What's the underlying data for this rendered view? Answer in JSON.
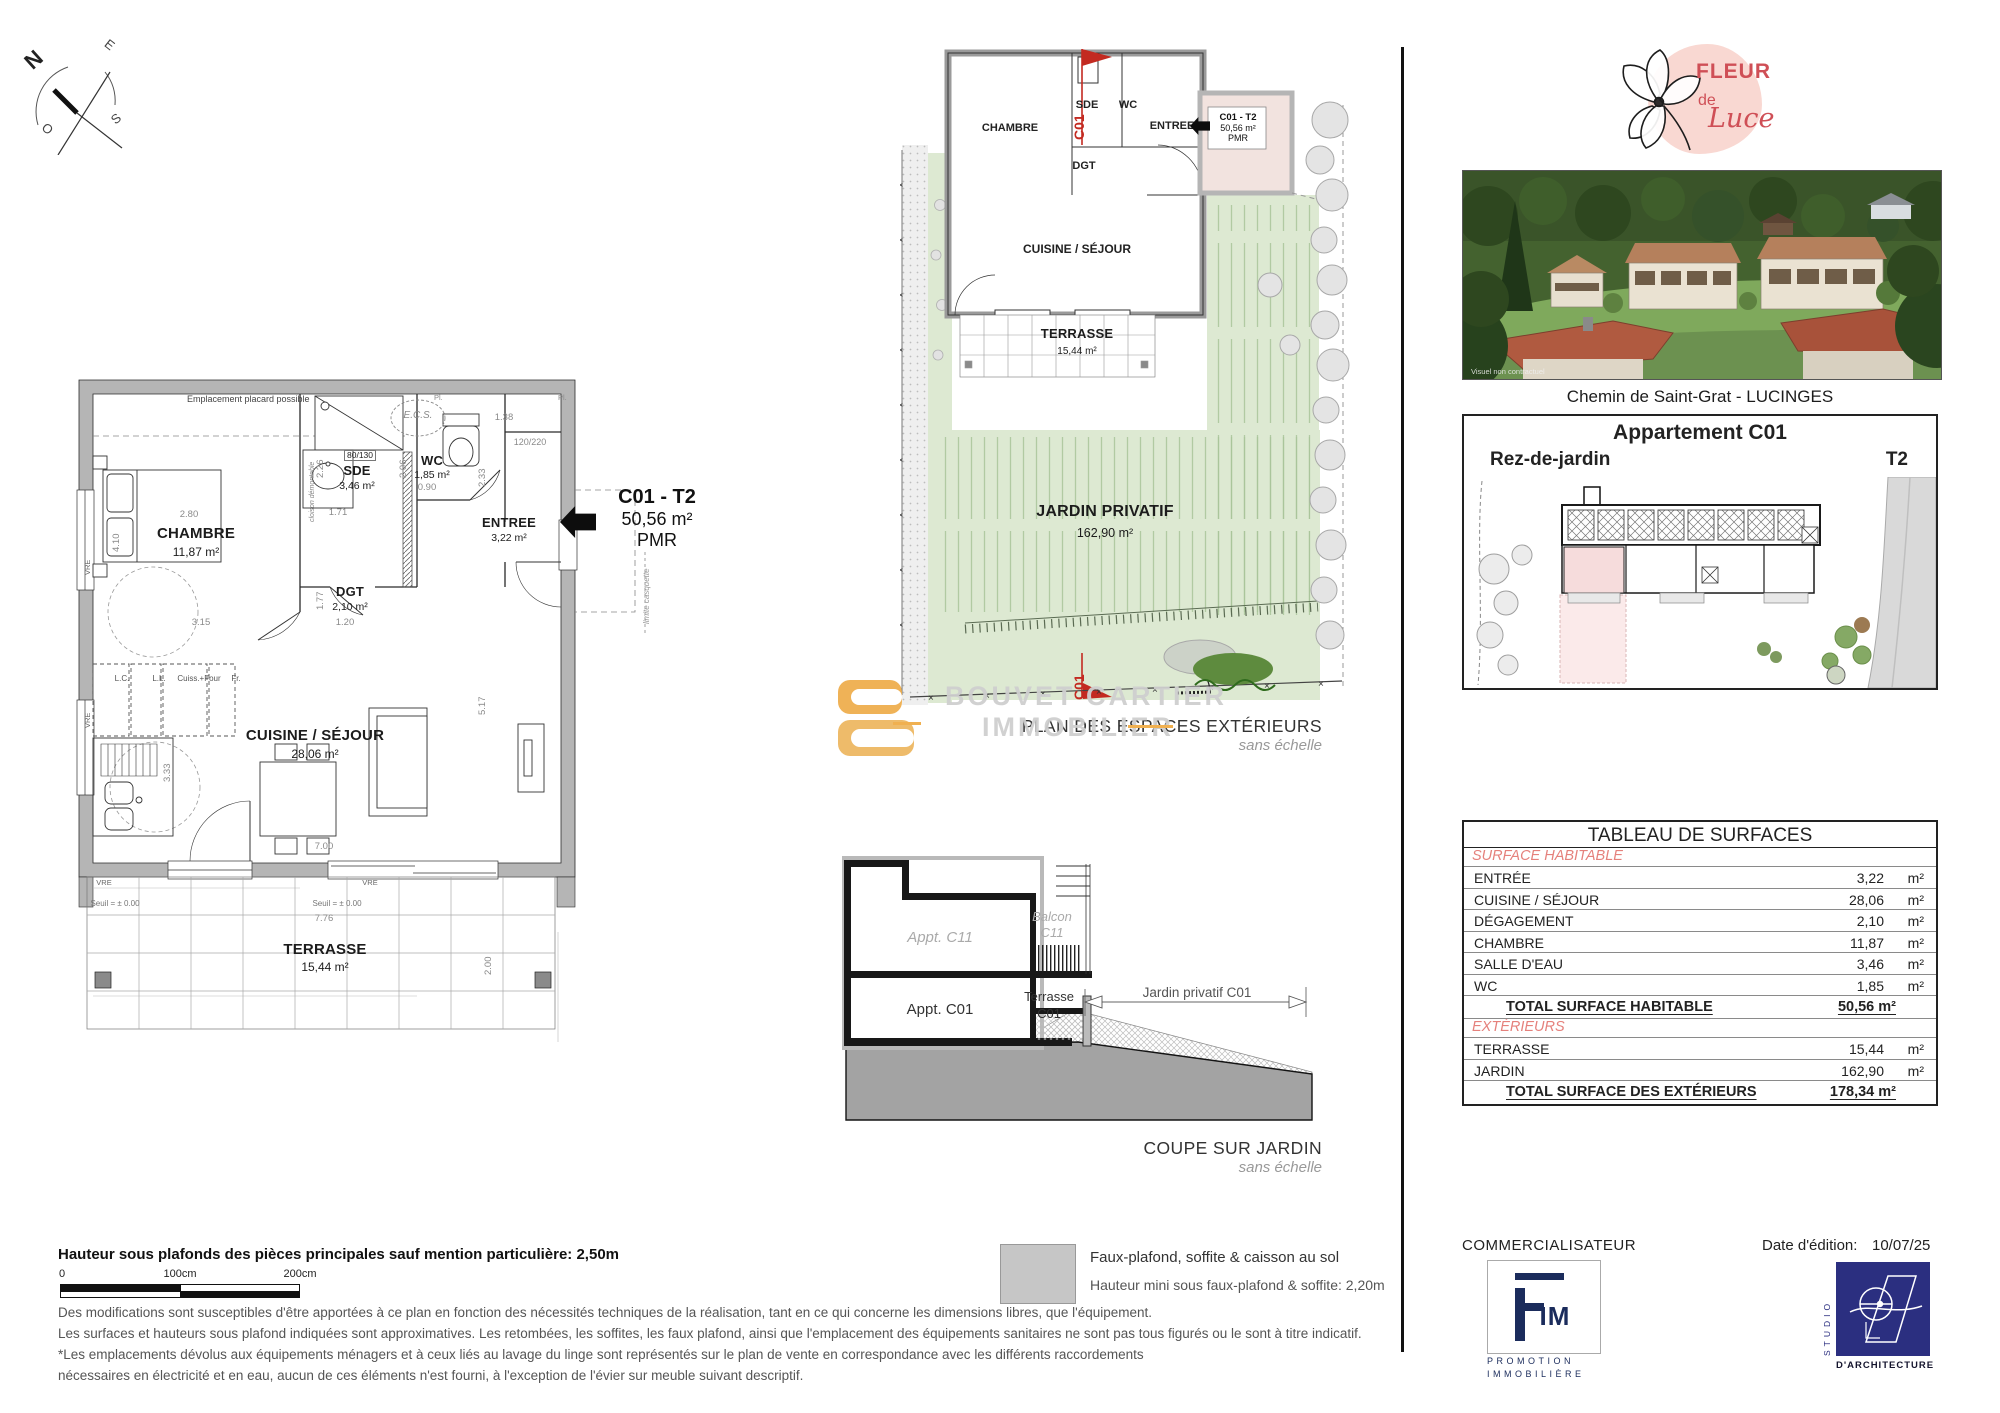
{
  "compass": {
    "n": "N",
    "e": "E",
    "s": "S",
    "o": "O"
  },
  "main_plan": {
    "note_placard": "Emplacement placard possible",
    "rooms": {
      "chambre": {
        "name": "CHAMBRE",
        "area": "11,87 m²"
      },
      "sde": {
        "name": "SDE",
        "area": "3,46 m²"
      },
      "wc": {
        "name": "WC",
        "area": "1,85 m²"
      },
      "entree": {
        "name": "ENTREE",
        "area": "3,22 m²"
      },
      "dgt": {
        "name": "DGT",
        "area": "2,10 m²"
      },
      "cuisine": {
        "name": "CUISINE / SÉJOUR",
        "area": "28,06 m²"
      },
      "terrasse": {
        "name": "TERRASSE",
        "area": "15,44 m²"
      }
    },
    "ecs": "E.C.S.",
    "door_sde": "80/130",
    "door_entree": "120/220",
    "pl": "Pl.",
    "appliances": {
      "lc": "L.C.",
      "ll": "L.L.",
      "cuiss": "Cuiss.+Four",
      "fr": "Fr."
    },
    "seuil": "Seuil = ± 0.00",
    "vre": "VRE",
    "cloison": "cloison démontable",
    "limite": "limite casquette",
    "dims": {
      "d280": "2.80",
      "d410": "4.10",
      "d315": "3.15",
      "d226": "2.26",
      "d171": "1.71",
      "d206": "2.06",
      "d090": "0.90",
      "d233": "2.33",
      "d138": "1.38",
      "d120220": "120/220",
      "d177": "1.77",
      "d120": "1.20",
      "d700": "7.00",
      "d517": "5.17",
      "d333": "3.33",
      "d776": "7.76",
      "d200": "2.00"
    },
    "unit_label": {
      "code": "C01 - T2",
      "area": "50,56 m²",
      "pmr": "PMR"
    }
  },
  "ext_plan": {
    "rooms": {
      "chambre": "CHAMBRE",
      "sde": "SDE",
      "wc": "WC",
      "entree": "ENTREE",
      "dgt": "DGT",
      "cuisine": "CUISINE / SÉJOUR"
    },
    "terrasse": {
      "name": "TERRASSE",
      "area": "15,44 m²"
    },
    "jardin": {
      "name": "JARDIN PRIVATIF",
      "area": "162,90 m²"
    },
    "unit_label": {
      "code": "C01 - T2",
      "area": "50,56 m²",
      "pmr": "PMR"
    },
    "section_mark": "C01",
    "caption": "PLAN DES ESPACES EXTÉRIEURS",
    "caption_sub": "sans échelle"
  },
  "watermark": {
    "line1": "BOUVET CARTIER",
    "line2": "IMMOBILIER"
  },
  "coupe": {
    "appt_c11": "Appt. C11",
    "appt_c01": "Appt. C01",
    "balcon_l1": "Balcon",
    "balcon_l2": "C11",
    "terrasse_l1": "Terrasse",
    "terrasse_l2": "C01",
    "jardin_dim": "Jardin privatif C01",
    "caption": "COUPE SUR JARDIN",
    "caption_sub": "sans échelle"
  },
  "sidebar": {
    "brand": {
      "fleur": "FLEUR",
      "de": "de",
      "luce": "Luce"
    },
    "photo_note": "Visuel non contractuel",
    "address": "Chemin de Saint-Grat - LUCINGES",
    "unit": {
      "title": "Appartement C01",
      "floor": "Rez-de-jardin",
      "type": "T2"
    },
    "table": {
      "title": "TABLEAU DE SURFACES",
      "rows": [
        {
          "kind": "section",
          "label": "SURFACE HABITABLE"
        },
        {
          "kind": "data",
          "label": "ENTRÉE",
          "value": "3,22",
          "unit": "m²"
        },
        {
          "kind": "data",
          "label": "CUISINE / SÉJOUR",
          "value": "28,06",
          "unit": "m²"
        },
        {
          "kind": "data",
          "label": "DÉGAGEMENT",
          "value": "2,10",
          "unit": "m²"
        },
        {
          "kind": "data",
          "label": "CHAMBRE",
          "value": "11,87",
          "unit": "m²"
        },
        {
          "kind": "data",
          "label": "SALLE D'EAU",
          "value": "3,46",
          "unit": "m²"
        },
        {
          "kind": "data",
          "label": "WC",
          "value": "1,85",
          "unit": "m²"
        },
        {
          "kind": "total",
          "label": "TOTAL SURFACE HABITABLE",
          "value": "50,56 m²"
        },
        {
          "kind": "section",
          "label": "EXTÉRIEURS"
        },
        {
          "kind": "data",
          "label": "TERRASSE",
          "value": "15,44",
          "unit": "m²"
        },
        {
          "kind": "data",
          "label": "JARDIN",
          "value": "162,90",
          "unit": "m²"
        },
        {
          "kind": "total",
          "label": "TOTAL SURFACE DES EXTÉRIEURS",
          "value": "178,34 m²"
        }
      ]
    }
  },
  "footer": {
    "commercialisateur": "COMMERCIALISATEUR",
    "fim": {
      "letters": "IM",
      "line1": "PROMOTION",
      "line2": "IMMOBILIÈRE"
    },
    "date_label": "Date d'édition:",
    "date_value": "10/07/25",
    "studio": {
      "vertical": "STUDIO",
      "caption": "D'ARCHITECTURE"
    },
    "height_note": "Hauteur sous plafonds des pièces principales sauf mention particulière: 2,50m",
    "scale": {
      "t0": "0",
      "t100": "100cm",
      "t200": "200cm"
    },
    "legend": {
      "line1": "Faux-plafond, soffite & caisson au sol",
      "line2": "Hauteur mini sous faux-plafond & soffite: 2,20m"
    },
    "disclaimer": [
      "Des modifications sont susceptibles d'être apportées à ce plan en fonction des nécessités techniques de la réalisation, tant en ce qui concerne les dimensions libres, que l'équipement.",
      "Les surfaces et hauteurs sous plafond indiquées sont approximatives. Les retombées, les soffites, les faux plafond, ainsi que l'emplacement des équipements sanitaires ne sont pas tous figurés ou le sont à titre indicatif.",
      "*Les emplacements dévolus aux équipements ménagers et à ceux liés au lavage du linge sont représentés sur le plan de vente en correspondance avec les différents raccordements",
      "nécessaires en électricité et en eau, aucun de ces éléments n'est fourni, à l'exception de l'évier sur meuble suivant descriptif."
    ]
  },
  "colors": {
    "accent_red": "#c32a21",
    "table_red": "#e5817c",
    "jardin_green": "#dde9d2",
    "wall_gray": "#b5b5b5",
    "navy_fim": "#1b2c5c",
    "navy_studio": "#2b2f80",
    "brand_pink": "#f9d8d2",
    "brand_red": "#cf4f56",
    "watermark_orange": "#eeaa45"
  }
}
